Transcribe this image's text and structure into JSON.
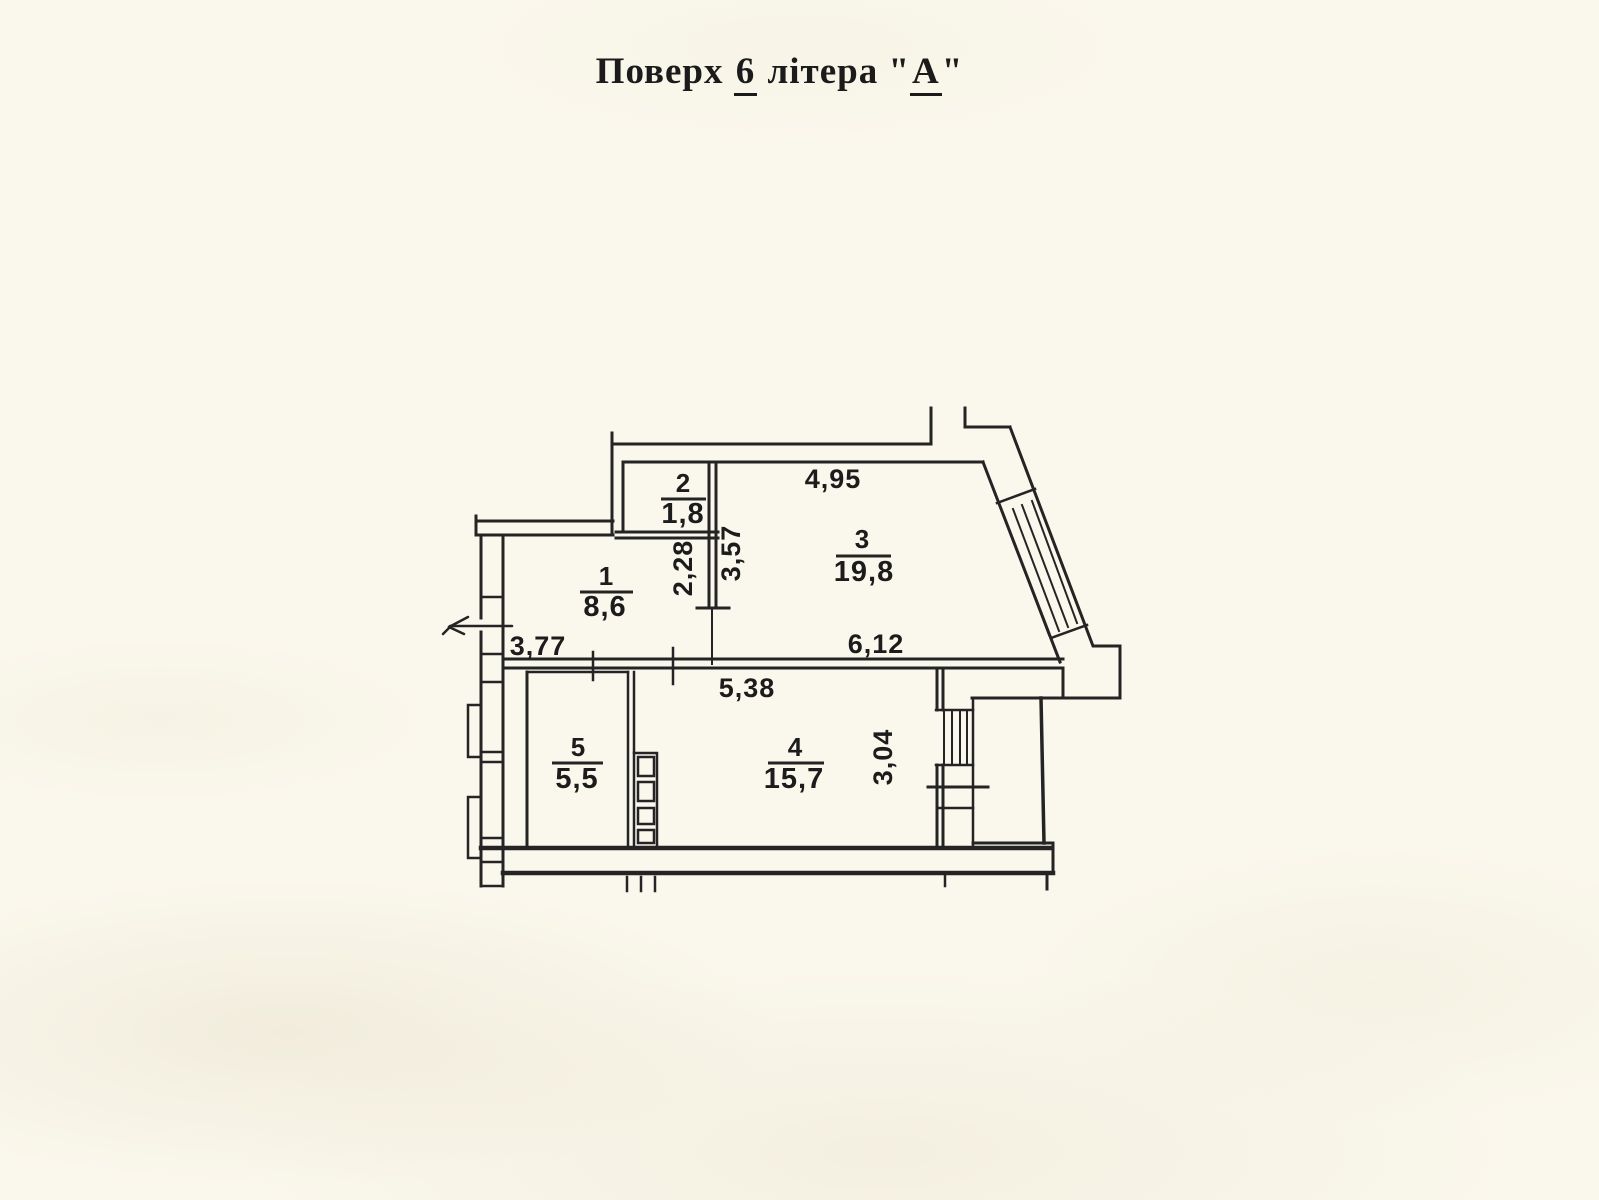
{
  "page": {
    "background_color": "#faf7ec",
    "ink_color": "#1c1c1c"
  },
  "title": {
    "word1": "Поверх",
    "floor_number": "6",
    "word2": "літера",
    "open_quote": "\"",
    "letter": "А",
    "close_quote": "\""
  },
  "floor_plan": {
    "rooms": [
      {
        "number": "1",
        "area": "8,6"
      },
      {
        "number": "2",
        "area": "1,8"
      },
      {
        "number": "3",
        "area": "19,8"
      },
      {
        "number": "4",
        "area": "15,7"
      },
      {
        "number": "5",
        "area": "5,5"
      }
    ],
    "dimensions": [
      {
        "label": "4,95",
        "orientation": "horizontal",
        "location": "room-3-top-width"
      },
      {
        "label": "3,57",
        "orientation": "vertical",
        "location": "room-3-left-height"
      },
      {
        "label": "2,28",
        "orientation": "vertical",
        "location": "room-1-right-height"
      },
      {
        "label": "3,77",
        "orientation": "horizontal",
        "location": "room-1-bottom-width"
      },
      {
        "label": "6,12",
        "orientation": "horizontal",
        "location": "room-3-bottom-width"
      },
      {
        "label": "5,38",
        "orientation": "horizontal",
        "location": "room-4-top-width"
      },
      {
        "label": "3,04",
        "orientation": "vertical",
        "location": "room-4-right-height"
      }
    ]
  }
}
